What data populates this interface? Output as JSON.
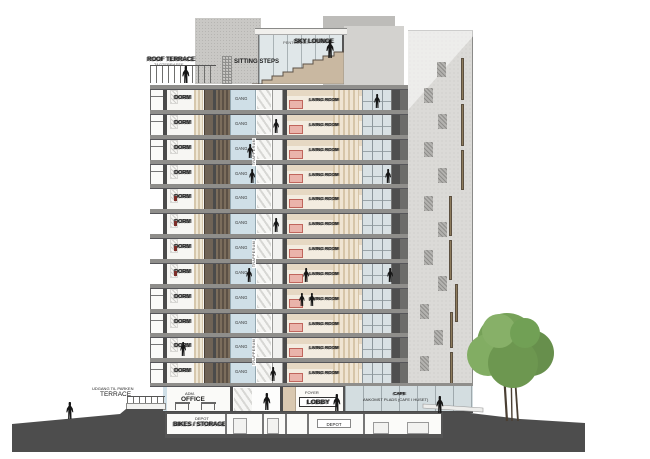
{
  "meta": {
    "drawing_type": "building cross-section elevation"
  },
  "rooftop": {
    "roof_terrace": "ROOF TERRACE",
    "roof_terrace_alt": "TAGTERRASSE",
    "sitting_steps": "SITTING STEPS",
    "penthouse": "PENTHOUSE",
    "sky_lounge": "SKY LOUNGE"
  },
  "tower": {
    "floor_count": 12,
    "labels": {
      "dorm": "DORM",
      "gang": "GANG",
      "living": "LIVING ROOM",
      "stairwell": "TRAPPERUM"
    },
    "floors": [
      {
        "inset": false
      },
      {
        "inset": false
      },
      {
        "inset": false
      },
      {
        "inset": false
      },
      {
        "inset": true
      },
      {
        "inset": true
      },
      {
        "inset": true
      },
      {
        "inset": true
      },
      {
        "inset": false
      },
      {
        "inset": false
      },
      {
        "inset": false
      },
      {
        "inset": false
      }
    ],
    "stairwell_positions": [
      {
        "x": 252,
        "y": 138
      },
      {
        "x": 252,
        "y": 240
      },
      {
        "x": 252,
        "y": 338
      }
    ]
  },
  "ground": {
    "exit": "UDGANG TIL PARKEN",
    "terrace": "TERRACE",
    "adm": "ADM.",
    "office": "OFFICE",
    "foyer": "FOYER",
    "lobby": "LOBBY",
    "cafe": "CAFE",
    "arrival": "ANKOMST PLADS (CAFE I HUSET)"
  },
  "basement": {
    "depot": "DEPOT",
    "bikes": "BIKES / STORAGE",
    "depot2": "DEPOT"
  },
  "figures": [
    {
      "x": 182,
      "y": 66,
      "h": 17
    },
    {
      "x": 326,
      "y": 40,
      "h": 18
    },
    {
      "x": 374,
      "y": 94,
      "h": 14
    },
    {
      "x": 273,
      "y": 119,
      "h": 14
    },
    {
      "x": 247,
      "y": 144,
      "h": 14
    },
    {
      "x": 249,
      "y": 169,
      "h": 14
    },
    {
      "x": 385,
      "y": 169,
      "h": 14
    },
    {
      "x": 273,
      "y": 218,
      "h": 14
    },
    {
      "x": 246,
      "y": 268,
      "h": 14
    },
    {
      "x": 303,
      "y": 268,
      "h": 14
    },
    {
      "x": 387,
      "y": 268,
      "h": 14
    },
    {
      "x": 299,
      "y": 293,
      "h": 13
    },
    {
      "x": 309,
      "y": 293,
      "h": 13
    },
    {
      "x": 180,
      "y": 342,
      "h": 14
    },
    {
      "x": 270,
      "y": 367,
      "h": 14
    },
    {
      "x": 263,
      "y": 393,
      "h": 17
    },
    {
      "x": 333,
      "y": 394,
      "h": 17
    },
    {
      "x": 436,
      "y": 396,
      "h": 17
    },
    {
      "x": 66,
      "y": 402,
      "h": 17
    }
  ],
  "facade": {
    "slits": [
      {
        "x": 461,
        "y": 58,
        "h": 42
      },
      {
        "x": 461,
        "y": 104,
        "h": 42
      },
      {
        "x": 461,
        "y": 150,
        "h": 40
      },
      {
        "x": 449,
        "y": 196,
        "h": 40
      },
      {
        "x": 449,
        "y": 240,
        "h": 40
      },
      {
        "x": 455,
        "y": 284,
        "h": 38
      },
      {
        "x": 450,
        "y": 312,
        "h": 36
      },
      {
        "x": 450,
        "y": 352,
        "h": 32
      }
    ],
    "patches": [
      {
        "x": 437,
        "y": 62
      },
      {
        "x": 424,
        "y": 88
      },
      {
        "x": 438,
        "y": 114
      },
      {
        "x": 424,
        "y": 142
      },
      {
        "x": 438,
        "y": 168
      },
      {
        "x": 424,
        "y": 196
      },
      {
        "x": 438,
        "y": 222
      },
      {
        "x": 424,
        "y": 250
      },
      {
        "x": 438,
        "y": 276
      },
      {
        "x": 420,
        "y": 304
      },
      {
        "x": 434,
        "y": 330
      },
      {
        "x": 420,
        "y": 356
      }
    ]
  },
  "colors": {
    "ground": "#4d4d4d",
    "cut_wall": "#4b4b4b",
    "slab": "#8f8e8b",
    "corridor_glass": "#cfdfe7",
    "wood": "#6b5e4f",
    "curtain": "#d3c2a6",
    "living_wall": "#e6d8c3",
    "furniture": "#eab4ab",
    "facade": "#dbdad7",
    "steps": "#c9b8a1",
    "tree": "#6f9a52"
  }
}
